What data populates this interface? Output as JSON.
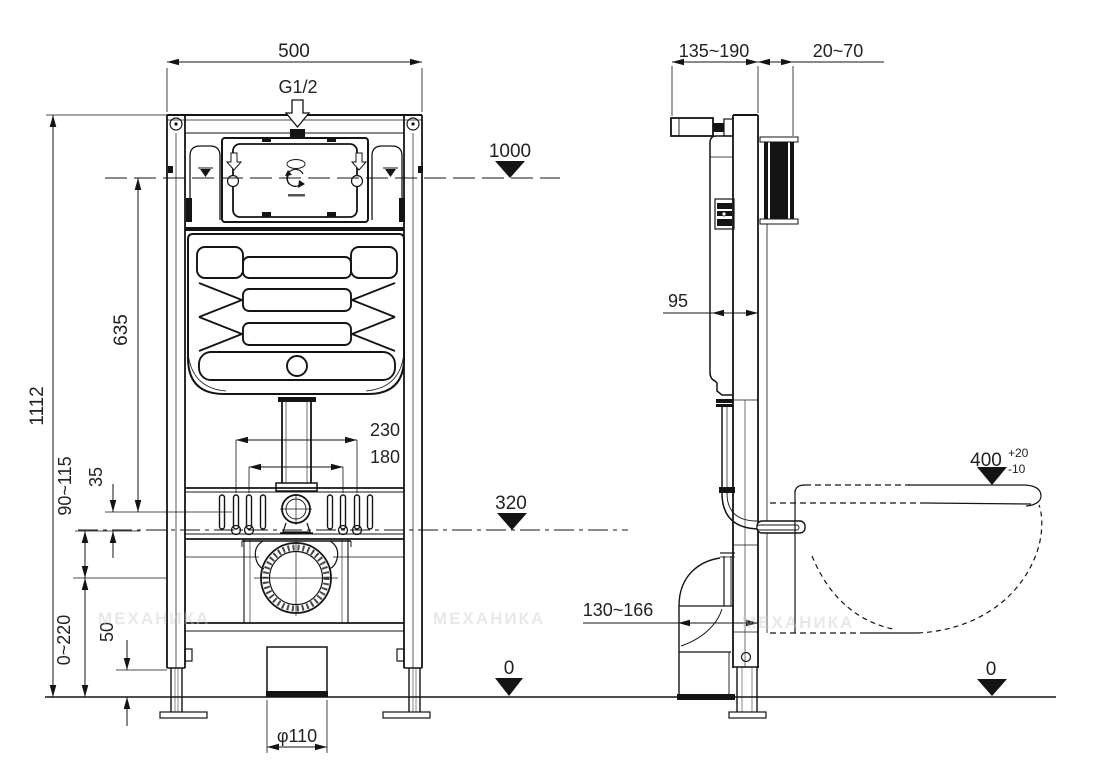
{
  "watermark": "МЕХАНИКА",
  "front_view": {
    "dim_width": "500",
    "inlet_thread": "G1/2",
    "level_top": "1000",
    "dim_height_overall": "1112",
    "dim_tank_height": "635",
    "dim_stud_offset": "35",
    "dim_stud_height_range": "90~115",
    "dim_bolt_span_outer": "230",
    "dim_bolt_span_inner": "180",
    "level_drain": "320",
    "dim_leg_adjust_range": "0~220",
    "dim_leg_base": "50",
    "dim_outlet_diameter": "φ110",
    "level_floor": "0"
  },
  "side_view": {
    "dim_frame_depth_range": "135~190",
    "dim_wall_finish_range": "20~70",
    "dim_tank_depth": "95",
    "dim_bowl_height": "400",
    "dim_bowl_tol_plus": "+20",
    "dim_bowl_tol_minus": "-10",
    "dim_drain_offset_range": "130~166",
    "level_floor": "0"
  }
}
